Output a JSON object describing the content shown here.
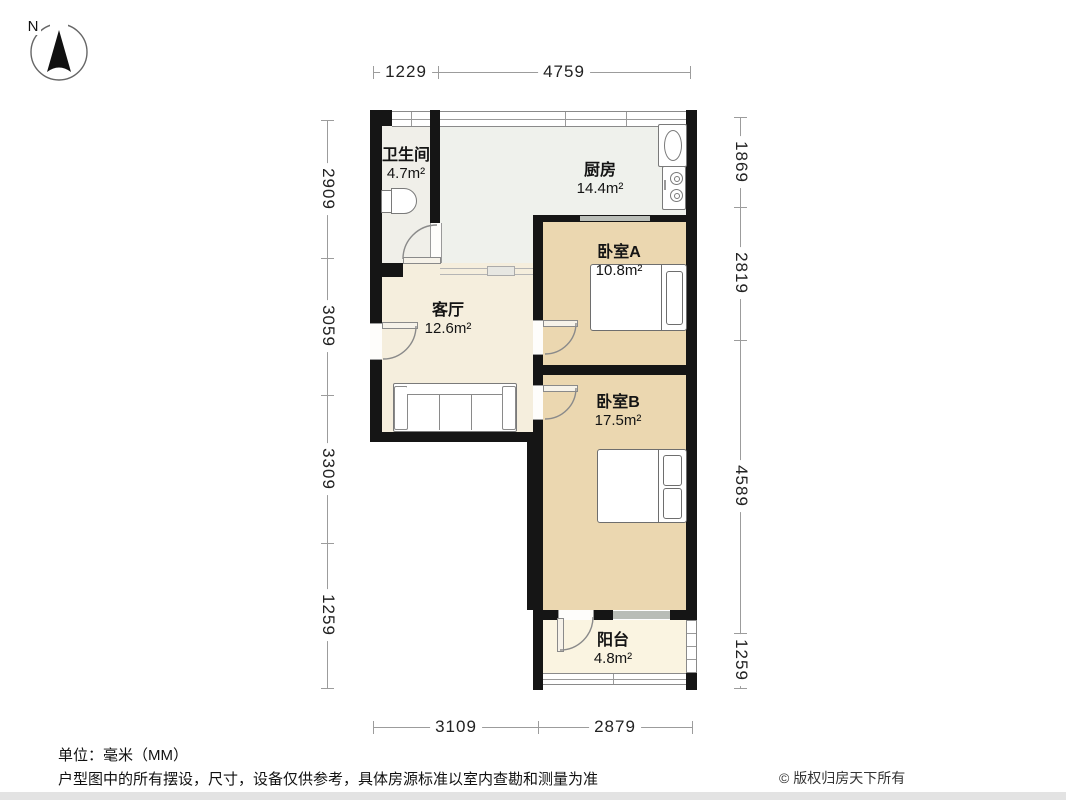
{
  "compass": {
    "label": "N"
  },
  "rooms": [
    {
      "id": "bathroom",
      "name": "卫生间",
      "area": "4.7m²"
    },
    {
      "id": "kitchen",
      "name": "厨房",
      "area": "14.4m²"
    },
    {
      "id": "bedroomA",
      "name": "卧室A",
      "area": "10.8m²"
    },
    {
      "id": "living",
      "name": "客厅",
      "area": "12.6m²"
    },
    {
      "id": "bedroomB",
      "name": "卧室B",
      "area": "17.5m²"
    },
    {
      "id": "balcony",
      "name": "阳台",
      "area": "4.8m²"
    }
  ],
  "dimensions": {
    "top": [
      {
        "label": "1229"
      },
      {
        "label": "4759"
      }
    ],
    "bottom": [
      {
        "label": "3109"
      },
      {
        "label": "2879"
      }
    ],
    "left": [
      {
        "label": "2909"
      },
      {
        "label": "3059"
      },
      {
        "label": "3309"
      },
      {
        "label": "1259"
      }
    ],
    "right": [
      {
        "label": "1869"
      },
      {
        "label": "2819"
      },
      {
        "label": "4589"
      },
      {
        "label": "1259"
      }
    ]
  },
  "footer": {
    "unit_note": "单位：毫米（MM）",
    "disclaimer": "户型图中的所有摆设，尺寸，设备仅供参考，具体房源标准以室内查勘和测量为准",
    "copyright": "© 版权归房天下所有"
  },
  "colors": {
    "wall": "#151515",
    "bedroom_floor": "#ebd7b0",
    "living_floor": "#f5eedd",
    "kitchen_floor": "#eff1ec",
    "bathroom_floor": "#f0efe9",
    "balcony_floor": "#faf4e1",
    "window_seg": "#b9bdb7"
  }
}
